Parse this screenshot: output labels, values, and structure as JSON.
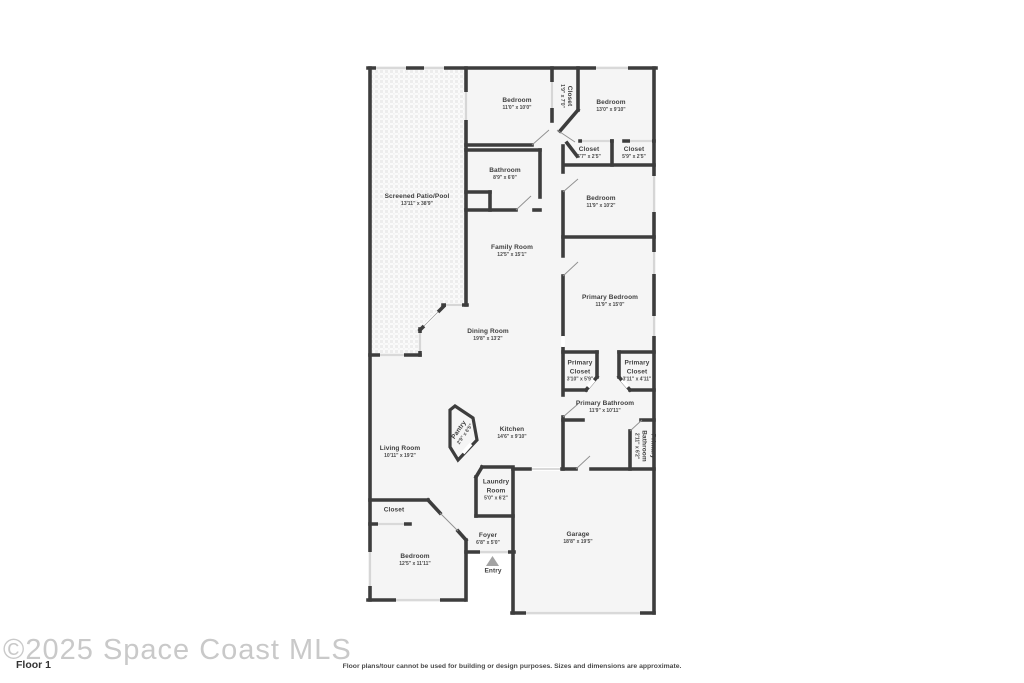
{
  "rooms": [
    {
      "id": "screened-patio",
      "name": "Screened Patio/Pool",
      "dims": "13'11\" x 38'9\""
    },
    {
      "id": "bedroom-top-left",
      "name": "Bedroom",
      "dims": "11'0\" x 10'0\""
    },
    {
      "id": "closet-hall",
      "name": "Closet",
      "dims": "1'9\" x 7'0\""
    },
    {
      "id": "bedroom-top-right",
      "name": "Bedroom",
      "dims": "13'0\" x 9'10\""
    },
    {
      "id": "closet-a",
      "name": "Closet",
      "dims": "5'7\" x 2'5\""
    },
    {
      "id": "closet-b",
      "name": "Closet",
      "dims": "5'9\" x 2'5\""
    },
    {
      "id": "bathroom",
      "name": "Bathroom",
      "dims": "8'9\" x 6'0\""
    },
    {
      "id": "bedroom-right",
      "name": "Bedroom",
      "dims": "11'9\" x 10'2\""
    },
    {
      "id": "family-room",
      "name": "Family Room",
      "dims": "12'5\" x 15'1\""
    },
    {
      "id": "primary-bedroom",
      "name": "Primary Bedroom",
      "dims": "11'9\" x 15'0\""
    },
    {
      "id": "dining-room",
      "name": "Dining Room",
      "dims": "19'8\" x 13'2\""
    },
    {
      "id": "primary-closet-left",
      "name": "Primary Closet",
      "dims": "3'10\" x 5'9\""
    },
    {
      "id": "primary-closet-right",
      "name": "Primary Closet",
      "dims": "3'11\" x 4'11\""
    },
    {
      "id": "primary-bathroom",
      "name": "Primary Bathroom",
      "dims": "11'9\" x 10'11\""
    },
    {
      "id": "primary-bathroom-wc",
      "name": "Primary Bathroom",
      "dims": "2'11\" x 6'2\""
    },
    {
      "id": "pantry",
      "name": "Pantry",
      "dims": "2'9\" x 6'5\""
    },
    {
      "id": "kitchen",
      "name": "Kitchen",
      "dims": "14'6\" x 9'10\""
    },
    {
      "id": "living-room",
      "name": "Living Room",
      "dims": "10'11\" x 19'2\""
    },
    {
      "id": "laundry-room",
      "name": "Laundry Room",
      "dims": "5'0\" x 6'2\""
    },
    {
      "id": "closet-bottom",
      "name": "Closet",
      "dims": ""
    },
    {
      "id": "bedroom-bottom",
      "name": "Bedroom",
      "dims": "12'5\" x 11'11\""
    },
    {
      "id": "foyer",
      "name": "Foyer",
      "dims": "6'8\" x 5'0\""
    },
    {
      "id": "entry",
      "name": "Entry",
      "dims": ""
    },
    {
      "id": "garage",
      "name": "Garage",
      "dims": "18'8\" x 19'5\""
    }
  ],
  "footer": {
    "copyright": "©2025 Space Coast MLS",
    "floor_label": "Floor 1",
    "disclaimer": "Floor plans/tour cannot be used for building or design purposes. Sizes and dimensions are approximate."
  },
  "colors": {
    "wall": "#3d3d3d",
    "room_fill": "#f5f5f5",
    "patio_texture": "#ededed",
    "entry_marker": "#a3a3a3",
    "label_text": "#3f3f3f",
    "copyright_text": "#c9c9c9"
  }
}
